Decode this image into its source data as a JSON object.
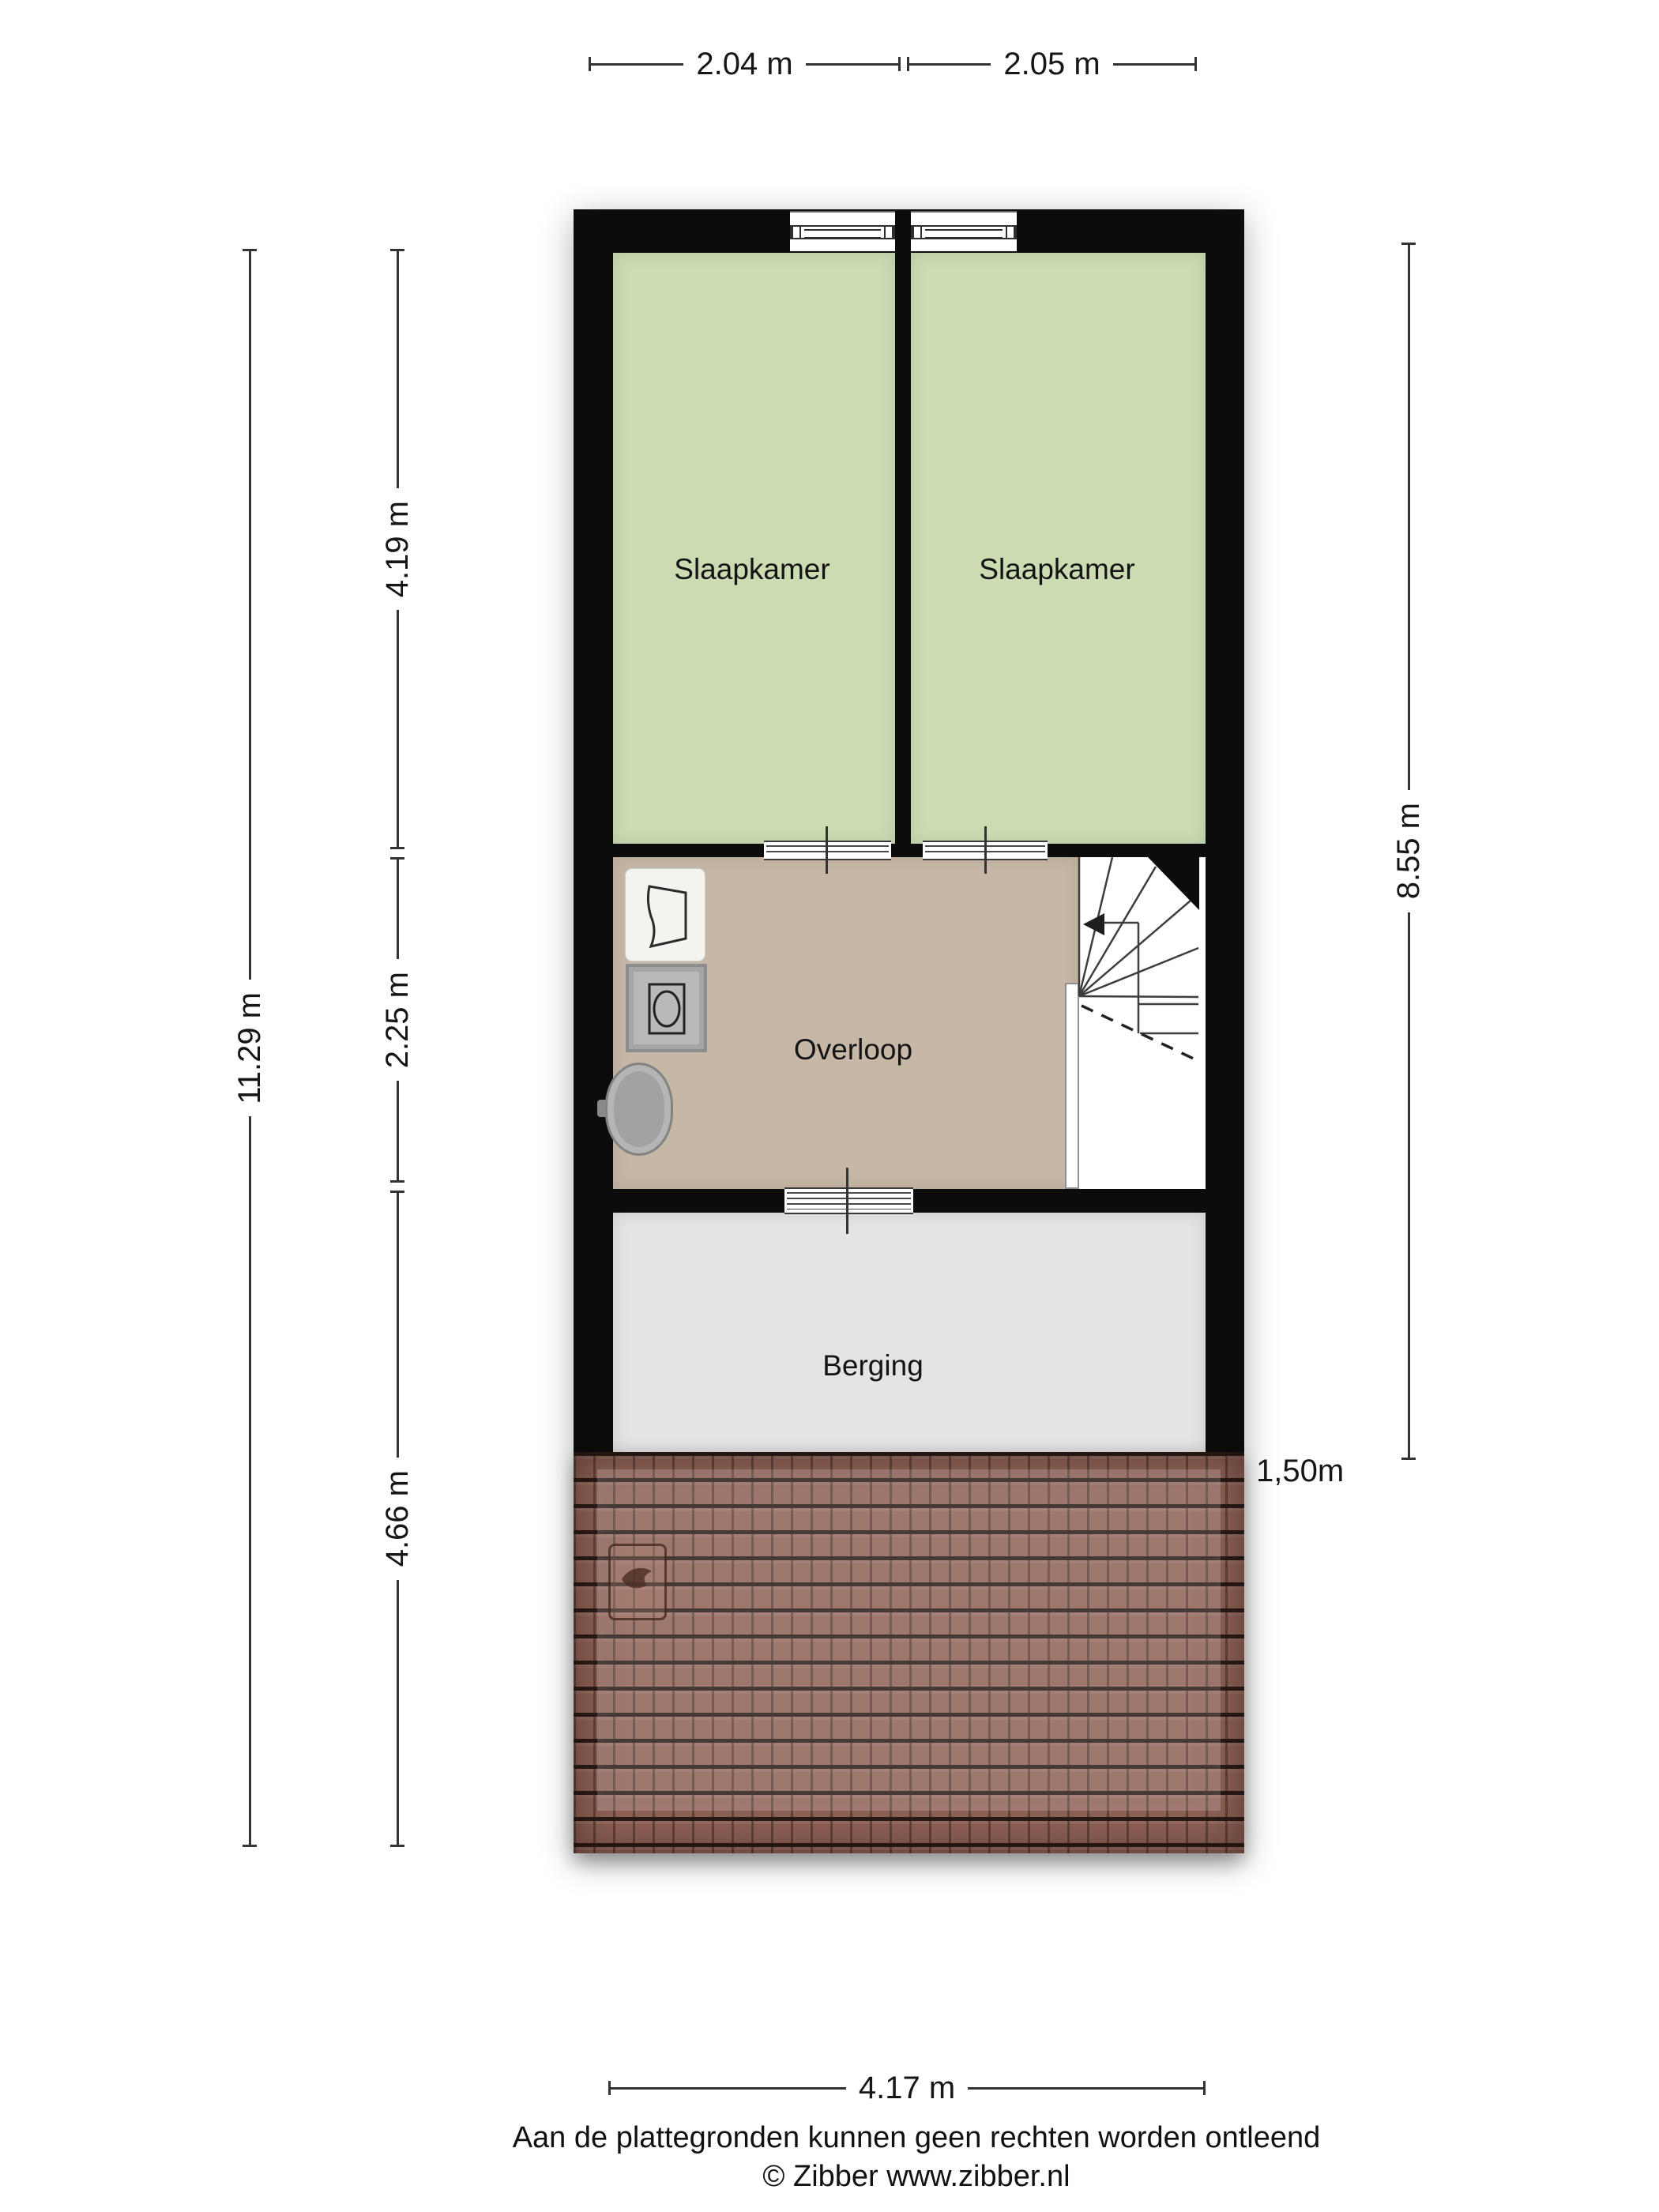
{
  "dimensions": {
    "top": [
      "2.04 m",
      "2.05 m"
    ],
    "left_total": "11.29 m",
    "left_segments": [
      "4.19 m",
      "2.25 m",
      "4.66 m"
    ],
    "right": "8.55 m",
    "bottom": "4.17 m",
    "roof_edge": "1,50m"
  },
  "rooms": [
    {
      "name": "Slaapkamer"
    },
    {
      "name": "Slaapkamer"
    },
    {
      "name": "Overloop"
    },
    {
      "name": "Berging"
    }
  ],
  "footer": {
    "disclaimer": "Aan de plattegronden kunnen geen rechten worden ontleend",
    "copyright": "© Zibber www.zibber.nl"
  },
  "icons": {
    "laundry": "laundry-basket-icon",
    "washer": "washing-machine-icon",
    "sink": "sink-icon",
    "skylight": "roof-window-icon",
    "stairs_arrow": "stairs-direction-arrow-icon"
  },
  "colors": {
    "wall": "#0c0c0c",
    "bedroom": "#cbdcb3",
    "overloop": "#c7b7a6",
    "berging": "#e4e4e6",
    "roof": "#8e6156",
    "line": "#333333",
    "text": "#161616"
  }
}
